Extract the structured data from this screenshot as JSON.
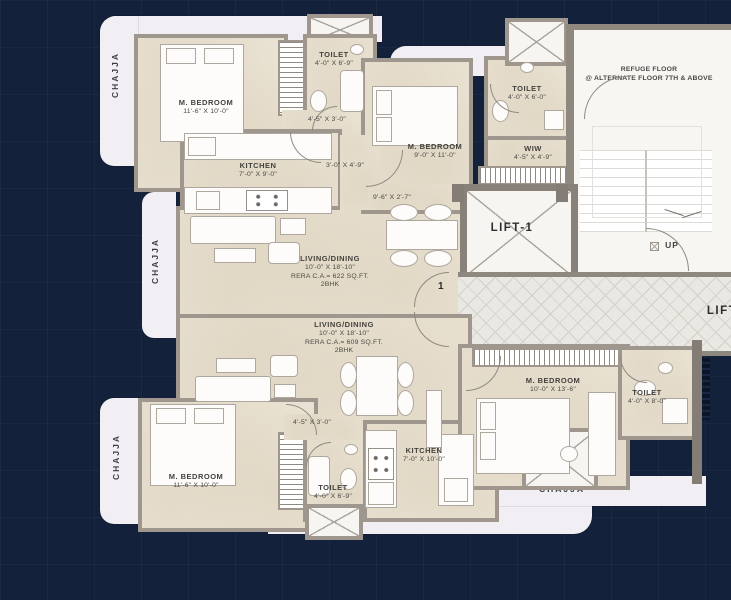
{
  "colors": {
    "background": "#14213b",
    "floor": "#e9e1d1",
    "wall": "#9f978e",
    "chajja": "#f1eff4",
    "white_room": "#f7f6f3",
    "accent_text": "#3a3a38"
  },
  "chajja": {
    "top_left": "CHAJJA",
    "mid_left": "CHAJJA",
    "bottom_left": "CHAJJA",
    "top": "CHAJJA",
    "bottom": "CHAJJA",
    "bottom_right": "CHAJJA"
  },
  "common": {
    "lift1": "LIFT-1",
    "lift_right": "LIFT",
    "up": "UP",
    "refuge_line1": "REFUGE FLOOR",
    "refuge_line2": "@ ALTERNATE FLOOR 7TH & ABOVE",
    "door1": "1",
    "door2": "2"
  },
  "unit1": {
    "bedroom1": {
      "name": "M. BEDROOM",
      "dims": "11'-6\" X 10'-0\""
    },
    "toilet1": {
      "name": "TOILET",
      "dims": "4'-0\" X 6'-9\""
    },
    "passage1": {
      "dims": "4'-5\" X 3'-0\""
    },
    "kitchen": {
      "name": "KITCHEN",
      "dims": "7'-0\" X 9'-0\""
    },
    "passage2": {
      "dims": "3'-0\" X 4'-9\""
    },
    "living": {
      "name": "LIVING/DINING",
      "dims": "10'-0\" X 18'-10\"",
      "rera": "RERA C.A.= 622 SQ.FT.",
      "type": "2BHK"
    },
    "bedroom2": {
      "name": "M. BEDROOM",
      "dims": "9'-0\" X 11'-0\""
    },
    "toilet2": {
      "name": "TOILET",
      "dims": "4'-0\" X 6'-0\""
    },
    "wiw": {
      "name": "WIW",
      "dims": "4'-5\" X 4'-9\""
    },
    "entry": {
      "dims": "9'-6\" X 2'-7\""
    }
  },
  "unit2": {
    "living": {
      "name": "LIVING/DINING",
      "dims": "10'-0\" X 18'-10\"",
      "rera": "RERA C.A.= 609 SQ.FT.",
      "type": "2BHK"
    },
    "bedroom1": {
      "name": "M. BEDROOM",
      "dims": "11'-6\" X 10'-0\""
    },
    "passage1": {
      "dims": "4'-5\" X 3'-0\""
    },
    "toilet1": {
      "name": "TOILET",
      "dims": "4'-0\" X 6'-9\""
    },
    "kitchen": {
      "name": "KITCHEN",
      "dims": "7'-0\" X 10'-0\""
    },
    "bedroom2": {
      "name": "M. BEDROOM",
      "dims": "10'-0\" X 13'-6\""
    },
    "toilet2": {
      "name": "TOILET",
      "dims": "4'-0\" X 8'-0\""
    }
  }
}
